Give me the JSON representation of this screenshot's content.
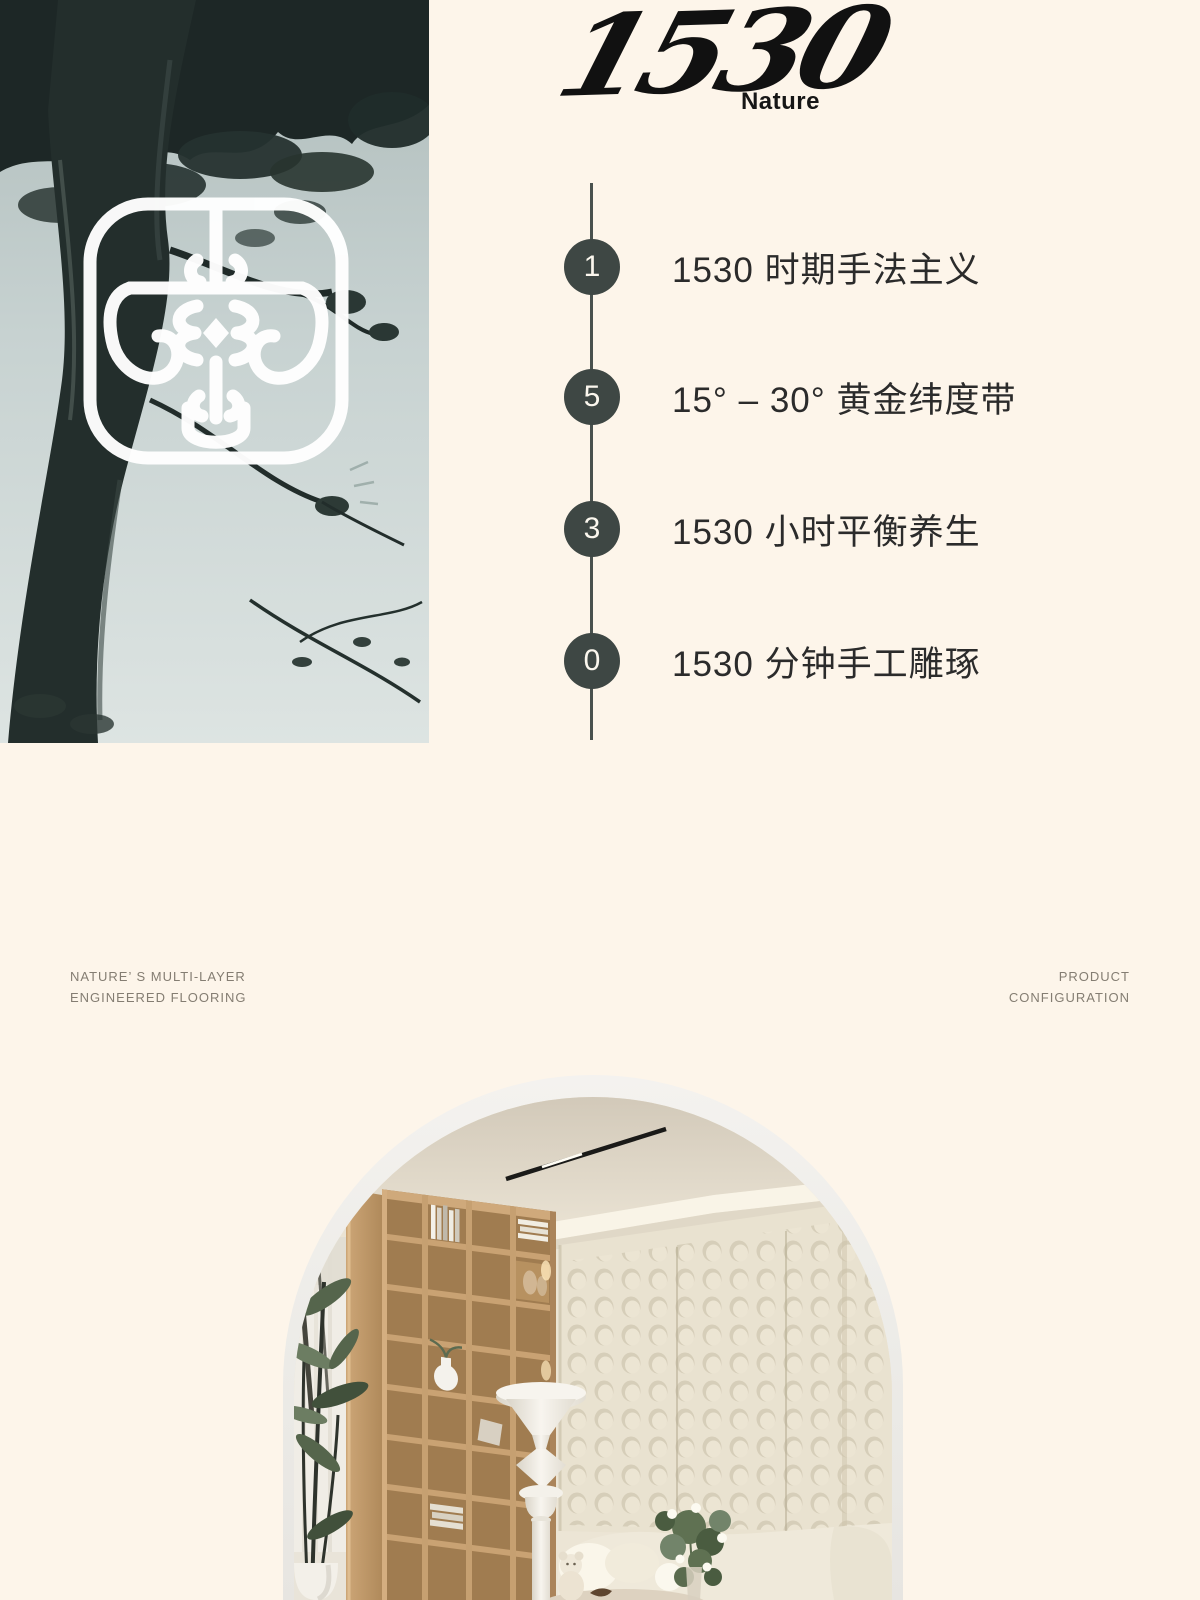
{
  "brand": {
    "logotype": "1530",
    "wordmark": "Nature"
  },
  "timeline": {
    "items": [
      {
        "digit": "1",
        "label": "1530 时期手法主义"
      },
      {
        "digit": "5",
        "label": "15° – 30° 黄金纬度带"
      },
      {
        "digit": "3",
        "label": "1530 小时平衡养生"
      },
      {
        "digit": "0",
        "label": "1530 分钟手工雕琢"
      }
    ]
  },
  "captions": {
    "left": {
      "line1": "NATURE’ S MULTI-LAYER",
      "line2": "ENGINEERED FLOORING"
    },
    "right": {
      "line1": "PRODUCT",
      "line2": "CONFIGURATION"
    }
  },
  "colors": {
    "background": "#fdf5ea",
    "circle_accent": "#3e4744",
    "timeline_text": "#2b2b2b",
    "caption_text": "#847d72",
    "logo_ink": "#111111"
  }
}
